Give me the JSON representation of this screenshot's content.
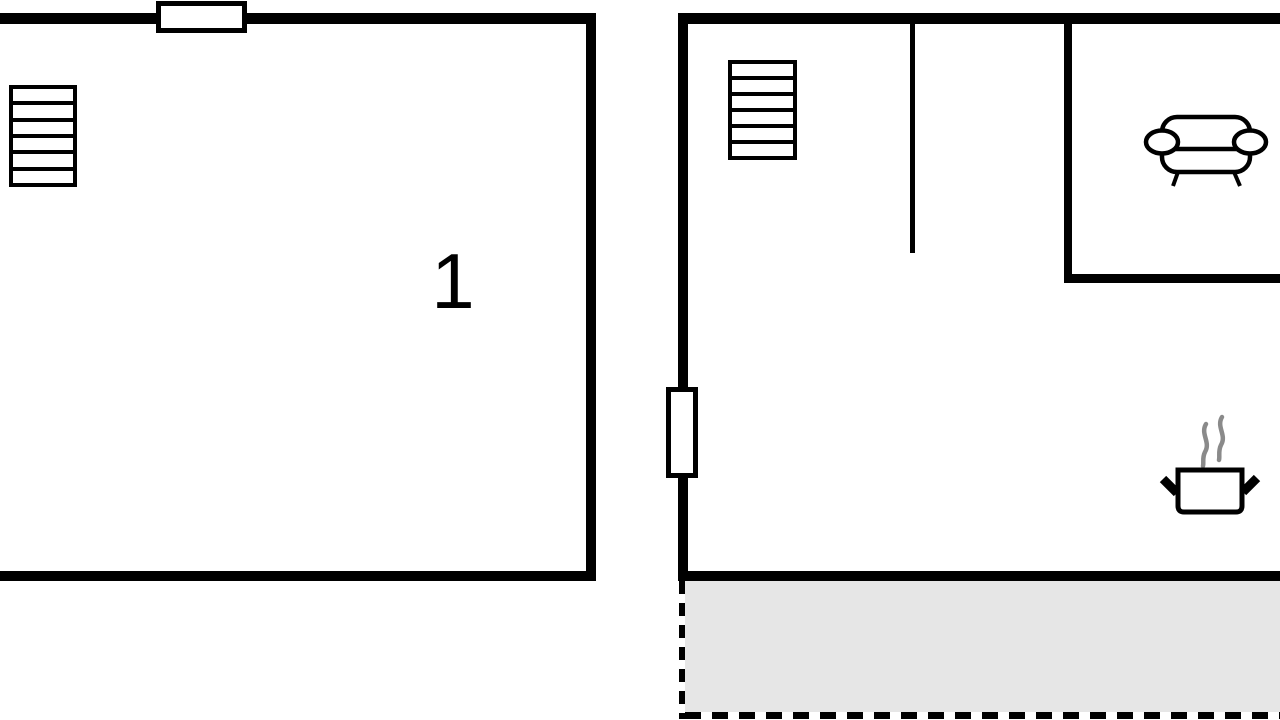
{
  "plan": {
    "type": "floor-plan",
    "colors": {
      "wall": "#000000",
      "background": "#ffffff",
      "terrace_fill": "#e6e6e6",
      "steam": "#8a8a8a"
    },
    "left_room": {
      "label": "1",
      "features": [
        "window-on-top-wall",
        "radiator"
      ]
    },
    "right_unit": {
      "features": [
        "radiator",
        "door-on-left-wall",
        "interior-wall",
        "lounge-partition-with-sofa",
        "cooking-pot-with-steam",
        "terrace-dashed-gray"
      ]
    }
  }
}
